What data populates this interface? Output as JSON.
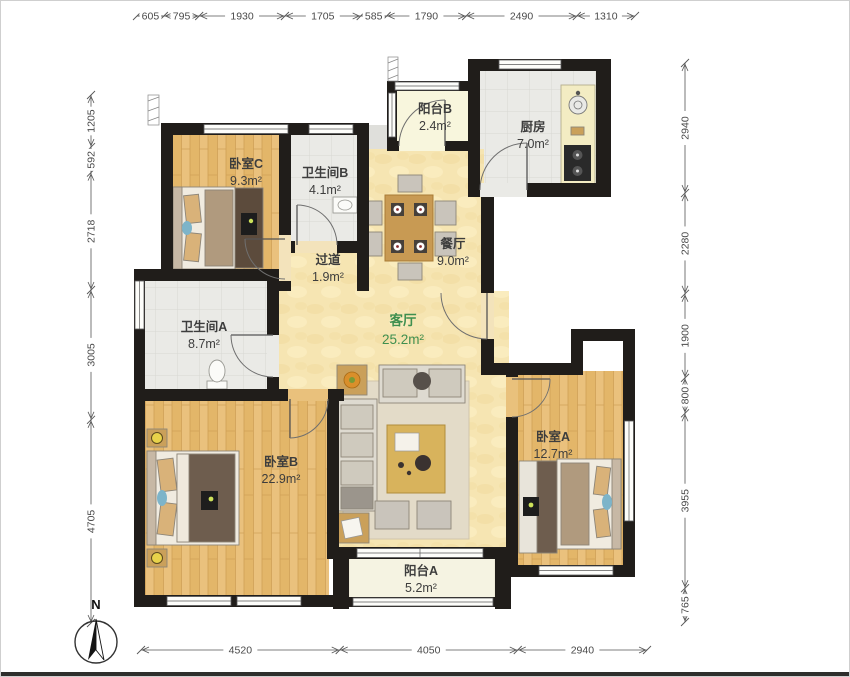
{
  "title": "apartment-floor-plan",
  "compass": {
    "north_label": "N"
  },
  "rooms": [
    {
      "id": "bedroom-c",
      "name": "卧室C",
      "area": "9.3m²"
    },
    {
      "id": "bathroom-b",
      "name": "卫生间B",
      "area": "4.1m²"
    },
    {
      "id": "hallway",
      "name": "过道",
      "area": "1.9m²"
    },
    {
      "id": "balcony-b",
      "name": "阳台B",
      "area": "2.4m²"
    },
    {
      "id": "kitchen",
      "name": "厨房",
      "area": "7.0m²"
    },
    {
      "id": "dining",
      "name": "餐厅",
      "area": "9.0m²"
    },
    {
      "id": "living",
      "name": "客厅",
      "area": "25.2m²"
    },
    {
      "id": "bathroom-a",
      "name": "卫生间A",
      "area": "8.7m²"
    },
    {
      "id": "bedroom-b",
      "name": "卧室B",
      "area": "22.9m²"
    },
    {
      "id": "bedroom-a",
      "name": "卧室A",
      "area": "12.7m²"
    },
    {
      "id": "balcony-a",
      "name": "阳台A",
      "area": "5.2m²"
    }
  ],
  "dimensions": {
    "top": [
      605,
      795,
      1930,
      1705,
      585,
      1790,
      2490,
      1310
    ],
    "left": [
      1205,
      592,
      2718,
      3005,
      4705
    ],
    "right": [
      2940,
      2280,
      1900,
      800,
      3955,
      765
    ],
    "bottom": [
      4520,
      4050,
      2940
    ]
  },
  "colors": {
    "wall": "#201d1a",
    "wood_floor": "#e9c17c",
    "tile_floor": "#eaeae6",
    "warm_floor": "#f6e5b2",
    "balcony_floor": "#f6f3df",
    "living_label_green": "#3f8f4f"
  }
}
